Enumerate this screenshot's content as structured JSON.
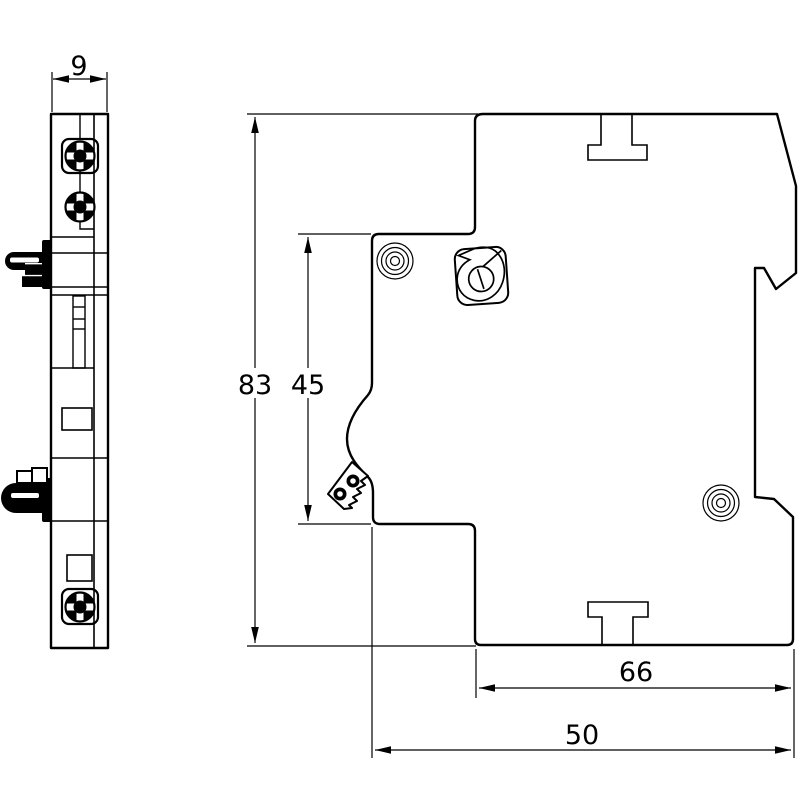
{
  "drawing": {
    "kind": "technical-dimension-drawing",
    "colors": {
      "line": "#000000",
      "background": "#ffffff"
    },
    "views": {
      "front": {
        "name": "front view (9 mm wide module)"
      },
      "side": {
        "name": "side profile with DIN-rail recess"
      }
    },
    "dims": {
      "width": {
        "label": "9"
      },
      "height": {
        "label": "83"
      },
      "front_height": {
        "label": "45"
      },
      "body_depth": {
        "label": "66"
      },
      "total_depth": {
        "label": "50"
      }
    }
  }
}
